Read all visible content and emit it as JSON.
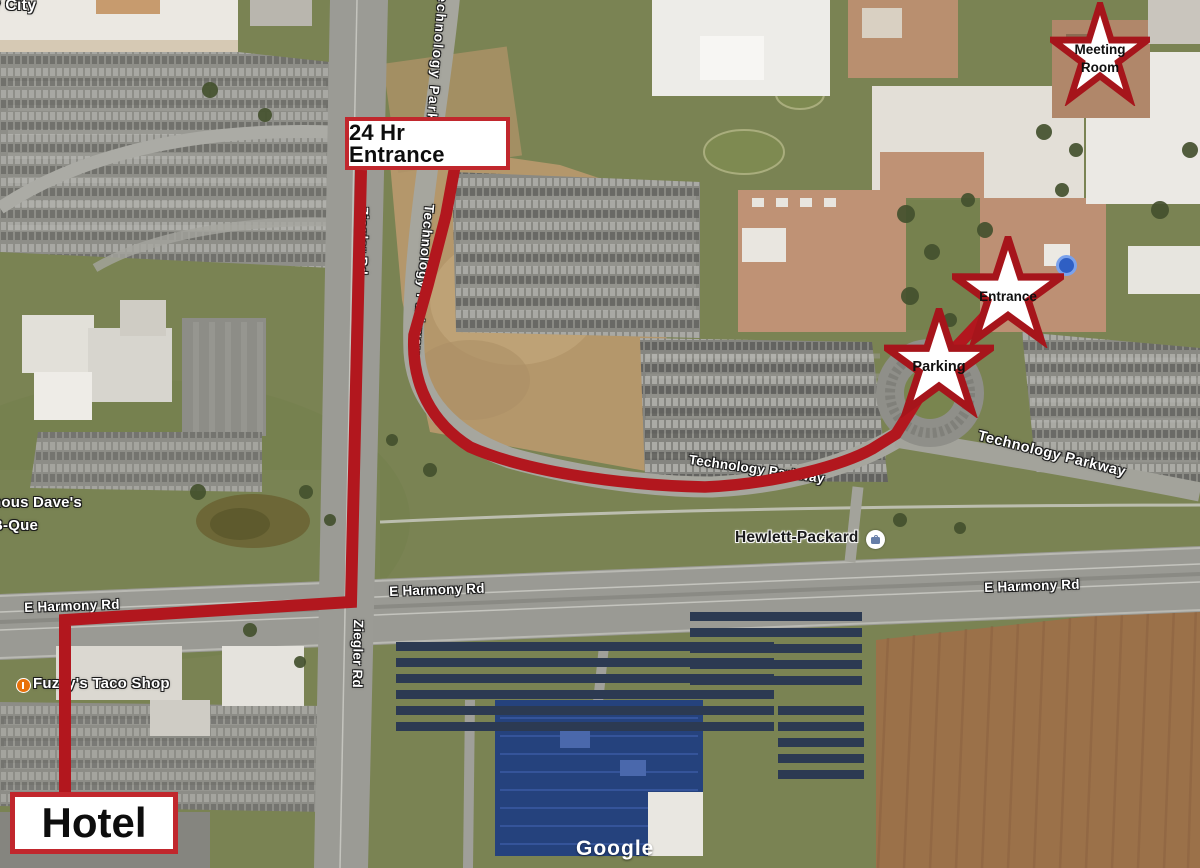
{
  "map": {
    "watermark": "Google",
    "colors": {
      "route": "#b2171e",
      "annotation_border": "#c1272d",
      "star_outline": "#a6151b",
      "location_dot": "#2f5fc4"
    },
    "road_labels": {
      "harmony_left": "E Harmony Rd",
      "harmony_mid": "E Harmony Rd",
      "harmony_right": "E Harmony Rd",
      "ziegler_upper": "Ziegler Rd",
      "ziegler_lower": "Ziegler Rd",
      "tech_park_top": "Technology Parkway",
      "tech_pkwy_diag": "Technology Parkway",
      "tech_pkwy_mid": "Technology Parkway",
      "tech_pkwy_right": "Technology Parkway"
    },
    "poi_labels": {
      "city_cutoff": "ty City",
      "dave_line1": "nous Dave's",
      "dave_line2": "B-Que",
      "fuzzys": "Fuzzy's Taco Shop",
      "hewlett_packard": "Hewlett-Packard"
    },
    "annotations": {
      "hotel": "Hotel",
      "entrance_24hr": "24 Hr Entrance",
      "star_meeting_line1": "Meeting",
      "star_meeting_line2": "Room",
      "star_entrance": "Entrance",
      "star_parking": "Parking"
    }
  }
}
